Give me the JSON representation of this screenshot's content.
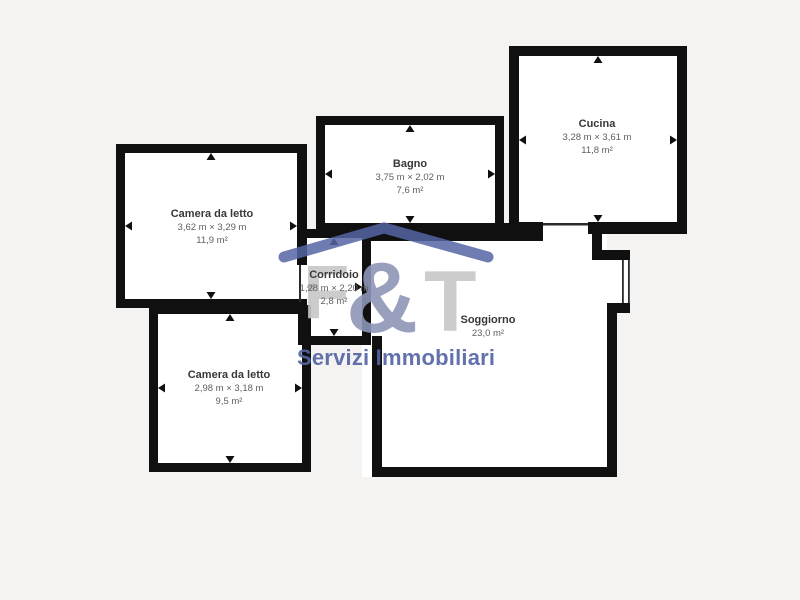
{
  "page": {
    "background_color": "#f4f3f1",
    "wall_color": "#101010",
    "floor_color": "#ffffff"
  },
  "watermark": {
    "letter_f": "F",
    "ampersand": "&",
    "letter_t": "T",
    "tagline": "Servizi Immobiliari",
    "roof_color": "#5565a4",
    "letter_gray": "#c7c7c7",
    "ampersand_color": "#8d96b8",
    "tagline_color": "#5565a4"
  },
  "rooms": [
    {
      "id": "camera-da-letto-1",
      "name": "Camera da letto",
      "dimensions": "3,62 m × 3,29 m",
      "area": "11,9 m²"
    },
    {
      "id": "bagno",
      "name": "Bagno",
      "dimensions": "3,75 m × 2,02 m",
      "area": "7,6 m²"
    },
    {
      "id": "cucina",
      "name": "Cucina",
      "dimensions": "3,28 m × 3,61 m",
      "area": "11,8 m²"
    },
    {
      "id": "corridoio",
      "name": "Corridoio",
      "dimensions": "1,28 m × 2,20 m",
      "area": "2,8 m²"
    },
    {
      "id": "soggiorno",
      "name": "Soggiorno",
      "dimensions": "",
      "area": "23,0 m²"
    },
    {
      "id": "camera-da-letto-2",
      "name": "Camera da letto",
      "dimensions": "2,98 m × 3,18 m",
      "area": "9,5 m²"
    }
  ]
}
